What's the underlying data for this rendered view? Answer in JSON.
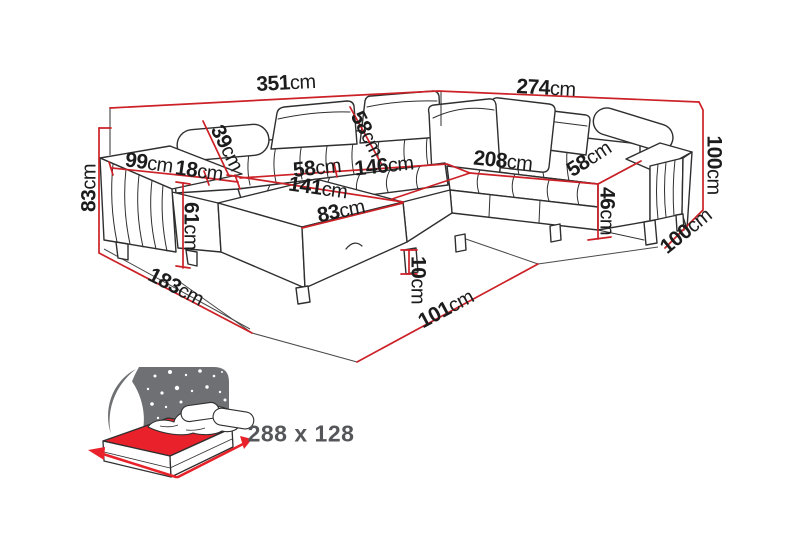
{
  "diagram": {
    "type": "corner-sofa-dimension-drawing",
    "unit": "cm",
    "dimensions": [
      {
        "name": "total-width-left",
        "value": "351",
        "unit": "cm"
      },
      {
        "name": "total-width-right",
        "value": "274",
        "unit": "cm"
      },
      {
        "name": "armrest-height-left",
        "value": "83",
        "unit": "cm"
      },
      {
        "name": "armrest-length",
        "value": "99",
        "unit": "cm"
      },
      {
        "name": "armrest-width",
        "value": "18",
        "unit": "cm"
      },
      {
        "name": "backrest-depth-left",
        "value": "39",
        "unit": "cm"
      },
      {
        "name": "backrest-depth-middle",
        "value": "58",
        "unit": "cm"
      },
      {
        "name": "seat-depth-left",
        "value": "58",
        "unit": "cm"
      },
      {
        "name": "seat-width-left",
        "value": "146",
        "unit": "cm"
      },
      {
        "name": "sleeping-length",
        "value": "141",
        "unit": "cm"
      },
      {
        "name": "chaise-width",
        "value": "83",
        "unit": "cm"
      },
      {
        "name": "seat-width-right",
        "value": "208",
        "unit": "cm"
      },
      {
        "name": "seat-depth-right",
        "value": "58",
        "unit": "cm"
      },
      {
        "name": "seat-height",
        "value": "46",
        "unit": "cm"
      },
      {
        "name": "total-height-right",
        "value": "100",
        "unit": "cm"
      },
      {
        "name": "side-depth-right",
        "value": "100",
        "unit": "cm"
      },
      {
        "name": "chaise-height",
        "value": "61",
        "unit": "cm"
      },
      {
        "name": "side-depth-left",
        "value": "183",
        "unit": "cm"
      },
      {
        "name": "leg-height",
        "value": "10",
        "unit": "cm"
      },
      {
        "name": "front-depth",
        "value": "101",
        "unit": "cm"
      }
    ],
    "sleeping_function": {
      "icon": "bed-sleeping-function-icon",
      "size_label": "288 x 128"
    },
    "colors": {
      "dimension_red": "#cc2127",
      "line_black": "#2f2f2f",
      "text_black": "#1c1c1c",
      "text_gray": "#55565a",
      "star_panel_gray": "#6f7073",
      "mattress_red": "#e8212a"
    }
  }
}
